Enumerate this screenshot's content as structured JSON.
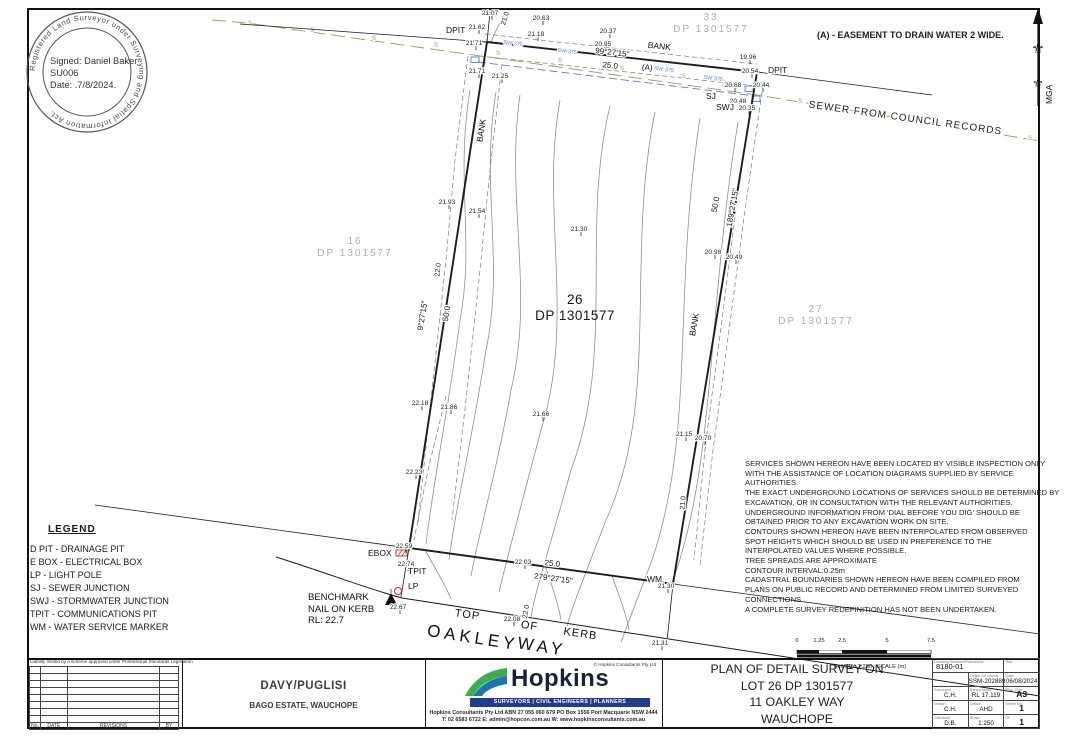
{
  "stamp": {
    "ring_text": "Registered Land Surveyor under Surveying and Spatial Information Act.",
    "line1": "Signed: Daniel Baker",
    "line2": "SU006",
    "line3": "Date: .7/8/2024."
  },
  "easement_note": "(A) - EASEMENT TO DRAIN WATER 2 WIDE.",
  "north_label": "MGA",
  "legend": {
    "title": "LEGEND",
    "items": [
      "D PIT - DRAINAGE PIT",
      "E BOX - ELECTRICAL BOX",
      "LP - LIGHT POLE",
      "SJ - SEWER JUNCTION",
      "SWJ - STORMWATER JUNCTION",
      "TPIT - COMMUNICATIONS PIT",
      "WM - WATER SERVICE MARKER"
    ]
  },
  "benchmark_lines": [
    "BENCHMARK",
    "NAIL ON KERB",
    "RL: 22.7"
  ],
  "notes": [
    "SERVICES SHOWN HEREON HAVE BEEN LOCATED BY VISIBLE INSPECTION ONLY",
    "WITH THE ASSISTANCE OF LOCATION DIAGRAMS SUPPLIED BY SERVICE",
    "AUTHORITIES.",
    "THE EXACT UNDERGROUND LOCATIONS OF SERVICES SHOULD BE DETERMINED BY",
    "EXCAVATION, OR IN CONSULTATION WITH THE RELEVANT AUTHORITIES.",
    "UNDERGROUND INFORMATION FROM 'DIAL BEFORE YOU DIG' SHOULD BE",
    "OBTAINED PRIOR TO ANY EXCAVATION WORK ON SITE.",
    "CONTOURS SHOWN HEREON HAVE BEEN INTERPOLATED FROM OBSERVED",
    "SPOT HEIGHTS WHICH SHOULD BE USED IN PREFERENCE TO THE",
    "INTERPOLATED VALUES WHERE POSSIBLE.",
    "TREE SPREADS ARE APPROXIMATE",
    "CONTOUR INTERVAL:0.25m",
    "CADASTRAL BOUNDARIES SHOWN HEREON HAVE BEEN COMPILED FROM",
    "PLANS ON PUBLIC RECORD AND DETERMINED FROM LIMITED SURVEYED",
    "CONNECTIONS.",
    "A COMPLETE SURVEY REDEFINITION HAS NOT BEEN UNDERTAKEN."
  ],
  "plan": {
    "colors": {
      "line": "#1c1c1c",
      "contour": "#8f8f8f",
      "contour_major": "#6b6b6b",
      "sewer_green": "#9a9a55",
      "sewer_blue": "#5b7fd0",
      "red": "#cc2a2a",
      "lot_gray": "#aeaeae"
    },
    "boundary": [
      [
        487,
        42
      ],
      [
        757,
        72
      ],
      [
        673,
        584
      ],
      [
        409,
        548
      ],
      [
        487,
        42
      ]
    ],
    "thin_lines": [
      [
        95,
        505,
        409,
        548
      ],
      [
        673,
        584,
        1040,
        634
      ],
      [
        757,
        72,
        932,
        95
      ],
      [
        240,
        24,
        487,
        42
      ],
      [
        490,
        12,
        487,
        42
      ],
      [
        409,
        548,
        401,
        597
      ],
      [
        673,
        584,
        667,
        641
      ]
    ],
    "kerb_path": "M276,557 C330,574 368,589 402,598 L1040,696",
    "contours": [
      "M470,90 C455,180 475,240 460,320 C450,400 435,470 426,544",
      "M496,92 C480,190 505,260 486,350 C472,440 456,505 449,560",
      "M520,95 C505,200 535,290 511,390 C497,470 479,532 471,576",
      "M560,100 C540,210 576,320 541,430 C522,502 506,562 499,592",
      "M610,106 C580,230 616,350 571,470 C552,540 536,587 531,617",
      "M655,112 C625,260 661,400 606,520 C587,570 572,606 566,630",
      "M700,118 C672,300 696,430 652,560 C637,600 627,626 621,642",
      "M738,122 C706,320 716,470 670,588",
      "M505,12 C499,25 494,34 491,42",
      "M425,550 C436,570 446,586 451,599",
      "M545,565 C552,586 558,603 561,620",
      "M612,576 C619,596 626,613 629,630"
    ],
    "dashed": [
      "M468,56 L455,160 L446,260 L432,390 L418,522",
      "M502,64 L490,170 L480,270 L466,400 L452,520",
      "M762,92 L745,210 L729,330 L713,450 L700,565",
      "M752,98 L737,200 L722,320 L706,440 L694,560",
      "M485,34 L757,64",
      "M479,56 L756,86",
      "M446,396 L428,470 L414,540"
    ],
    "sewer_green_pts": [
      [
        212,
        20
      ],
      [
        247,
        23
      ],
      [
        757,
        95
      ],
      [
        1040,
        141
      ]
    ],
    "sewer_s_marks": [
      [
        250,
        25
      ],
      [
        312,
        32
      ],
      [
        374,
        40
      ],
      [
        436,
        47
      ],
      [
        498,
        55
      ],
      [
        560,
        62
      ],
      [
        622,
        70
      ],
      [
        684,
        78
      ],
      [
        740,
        88
      ],
      [
        800,
        103
      ],
      [
        862,
        113
      ],
      [
        924,
        123
      ],
      [
        986,
        133
      ],
      [
        1030,
        140
      ]
    ],
    "sewer_blue": [
      [
        478,
        62
      ],
      [
        755,
        96
      ]
    ],
    "blue_boxes": [
      [
        471,
        57
      ],
      [
        745,
        86
      ],
      [
        752,
        96
      ]
    ],
    "corner_marks": [
      [
        487,
        42
      ],
      [
        757,
        72
      ],
      [
        486,
        13
      ],
      [
        409,
        548
      ],
      [
        673,
        584
      ]
    ],
    "spots": [
      [
        490,
        12,
        "21.07"
      ],
      [
        541,
        17,
        "20.63"
      ],
      [
        608,
        30,
        "20.37"
      ],
      [
        477,
        26,
        "21.62"
      ],
      [
        536,
        33,
        "21.18"
      ],
      [
        603,
        43,
        "20.95"
      ],
      [
        474,
        42,
        "21.71"
      ],
      [
        477,
        70,
        "21.71"
      ],
      [
        500,
        75,
        "21.25"
      ],
      [
        748,
        56,
        "19.96"
      ],
      [
        750,
        70,
        "20.54"
      ],
      [
        733,
        84,
        "20.68"
      ],
      [
        761,
        84,
        "20.44"
      ],
      [
        738,
        100,
        "20.48"
      ],
      [
        747,
        107,
        "20.35"
      ],
      [
        447,
        201,
        "21.93"
      ],
      [
        477,
        210,
        "21.54"
      ],
      [
        579,
        228,
        "21.30"
      ],
      [
        713,
        251,
        "20.98"
      ],
      [
        734,
        256,
        "20.49"
      ],
      [
        420,
        402,
        "22.18"
      ],
      [
        449,
        406,
        "21.86"
      ],
      [
        541,
        413,
        "21.66"
      ],
      [
        414,
        471,
        "22.23"
      ],
      [
        684,
        433,
        "21.15"
      ],
      [
        703,
        437,
        "20.70"
      ],
      [
        404,
        545,
        "22.59"
      ],
      [
        406,
        563,
        "22.74"
      ],
      [
        523,
        561,
        "22.03"
      ],
      [
        512,
        618,
        "22.08"
      ],
      [
        398,
        606,
        "22.67"
      ],
      [
        666,
        585,
        "21.30"
      ],
      [
        660,
        642,
        "21.31"
      ]
    ],
    "point_labels": [
      {
        "t": "DPIT",
        "x": 446,
        "y": 33
      },
      {
        "t": "DPIT",
        "x": 768,
        "y": 73
      },
      {
        "t": "SJ",
        "x": 706,
        "y": 99
      },
      {
        "t": "SWJ",
        "x": 716,
        "y": 110
      },
      {
        "t": "EBOX",
        "x": 368,
        "y": 556
      },
      {
        "t": "TPIT",
        "x": 408,
        "y": 574
      },
      {
        "t": "LP",
        "x": 408,
        "y": 589
      },
      {
        "t": "WM",
        "x": 647,
        "y": 582
      }
    ],
    "dims": [
      {
        "t": "99°27'15\"",
        "x": 612,
        "y": 55,
        "r": 6.5,
        "s": 8
      },
      {
        "t": "25.0",
        "x": 610,
        "y": 68,
        "r": 6.5,
        "s": 8
      },
      {
        "t": "(A)",
        "x": 647,
        "y": 70,
        "r": 6.5,
        "s": 8
      },
      {
        "t": "9°27'15\"",
        "x": 425,
        "y": 316,
        "r": -81,
        "s": 8
      },
      {
        "t": "50.0",
        "x": 449,
        "y": 314,
        "r": -81,
        "s": 8
      },
      {
        "t": "189°27'15\"",
        "x": 735,
        "y": 208,
        "r": -80,
        "s": 8
      },
      {
        "t": "50.0",
        "x": 718,
        "y": 205,
        "r": -80,
        "s": 8
      },
      {
        "t": "279°27'15\"",
        "x": 553,
        "y": 581,
        "r": 7.5,
        "s": 8
      },
      {
        "t": "25.0",
        "x": 552,
        "y": 566,
        "r": 7.5,
        "s": 8
      },
      {
        "t": "21.0",
        "x": 507,
        "y": 19,
        "r": -73,
        "s": 7
      },
      {
        "t": "22.0",
        "x": 440,
        "y": 270,
        "r": -84,
        "s": 7
      },
      {
        "t": "21.0",
        "x": 685,
        "y": 503,
        "r": -86,
        "s": 7
      },
      {
        "t": "22.0",
        "x": 528,
        "y": 612,
        "r": -80,
        "s": 7
      },
      {
        "t": "BANK",
        "x": 659,
        "y": 49,
        "r": 6.5,
        "s": 8.5
      },
      {
        "t": "BANK",
        "x": 484,
        "y": 131,
        "r": -81,
        "s": 8.5
      },
      {
        "t": "BANK",
        "x": 697,
        "y": 325,
        "r": -80,
        "s": 8.5
      }
    ],
    "street": [
      {
        "t": "TOP",
        "x": 467,
        "y": 618,
        "r": 8,
        "s": 11,
        "ls": 1
      },
      {
        "t": "OF",
        "x": 529,
        "y": 629,
        "r": 8,
        "s": 11,
        "ls": 1
      },
      {
        "t": "KERB",
        "x": 580,
        "y": 637,
        "r": 8,
        "s": 11,
        "ls": 1
      },
      {
        "t": "OAKLEY",
        "x": 472,
        "y": 643,
        "r": 9,
        "s": 17,
        "ls": 4
      },
      {
        "t": "WAY",
        "x": 541,
        "y": 652,
        "r": 9,
        "s": 17,
        "ls": 4
      }
    ],
    "sewer_text": {
      "t": "SEWER FROM COUNCIL RECORDS",
      "x": 905,
      "y": 121,
      "r": 8,
      "s": 10
    },
    "sw_labels": [
      {
        "t": "SW 375",
        "x": 513,
        "y": 45,
        "r": 7
      },
      {
        "t": "SW 375",
        "x": 567,
        "y": 53,
        "r": 7
      },
      {
        "t": "SW 375",
        "x": 664,
        "y": 71,
        "r": 7
      },
      {
        "t": "SW 375",
        "x": 713,
        "y": 80,
        "r": 7
      }
    ],
    "lots": [
      {
        "num": "33",
        "dp": "DP 1301577",
        "x": 711,
        "y": 14,
        "gray": true
      },
      {
        "num": "16",
        "dp": "DP 1301577",
        "x": 355,
        "y": 238,
        "gray": true
      },
      {
        "num": "27",
        "dp": "DP 1301577",
        "x": 816,
        "y": 306,
        "gray": true
      },
      {
        "num": "26",
        "dp": "DP 1301577",
        "x": 575,
        "y": 298,
        "gray": false
      }
    ]
  },
  "scalebar": {
    "ticks": [
      "0",
      "1.25",
      "2.5",
      "5",
      "7.5"
    ],
    "tick_pos": [
      2,
      24,
      47,
      92,
      136
    ],
    "caption": "Full Size 1:250 ; SCALE (m)"
  },
  "footer": {
    "liability": "Liability limited by a scheme approved under Professional Standards Legislation",
    "revision_headers": [
      "No.",
      "DATE",
      "REVISIONS",
      "BY"
    ],
    "client_name": "DAVY/PUGLISI",
    "client_sub": "BAGO ESTATE, WAUCHOPE",
    "company": {
      "name": "Hopkins",
      "copyright": "© Hopkins Consultants Pty Ltd",
      "tagline": "SURVEYORS | CIVIL ENGINEERS | PLANNERS",
      "address": "Hopkins Consultants Pty Ltd   ABN 27 055 060 679   PO Box 1556 Port Macquarie NSW 2444",
      "contact": "T: 02 6583 6722   E: admin@hopcon.com.au   W: www.hopkinsconsultants.com.au"
    },
    "title_lines": [
      "PLAN OF DETAIL SURVEY ON",
      "LOT 26 DP 1301577",
      "11 OAKLEY WAY",
      "WAUCHOPE"
    ],
    "info": {
      "ref_label": "Drawing Number/Reference",
      "ref": "8180-01",
      "rev_label": "Rev.",
      "rows": [
        [
          {
            "l": "",
            "v": ""
          },
          {
            "l": "Origin Of Levels",
            "v": "SSM-202889"
          },
          {
            "l": "Date",
            "v": "06/08/2024"
          }
        ],
        [
          {
            "l": "Surveyed",
            "v": "C.H."
          },
          {
            "l": "Bench Mark",
            "v": "RL 17.119"
          },
          {
            "l": "Plan Size",
            "v": "A3",
            "big": true
          }
        ],
        [
          {
            "l": "Drawn",
            "v": "C.H."
          },
          {
            "l": "Datum",
            "v": "AHD"
          },
          {
            "l": "Sheet No.",
            "v": "1",
            "big": true
          }
        ],
        [
          {
            "l": "Checked",
            "v": "D.B."
          },
          {
            "l": "Scale",
            "v": "1:250"
          },
          {
            "l": "Of",
            "v": "1",
            "big": true
          }
        ]
      ]
    }
  }
}
